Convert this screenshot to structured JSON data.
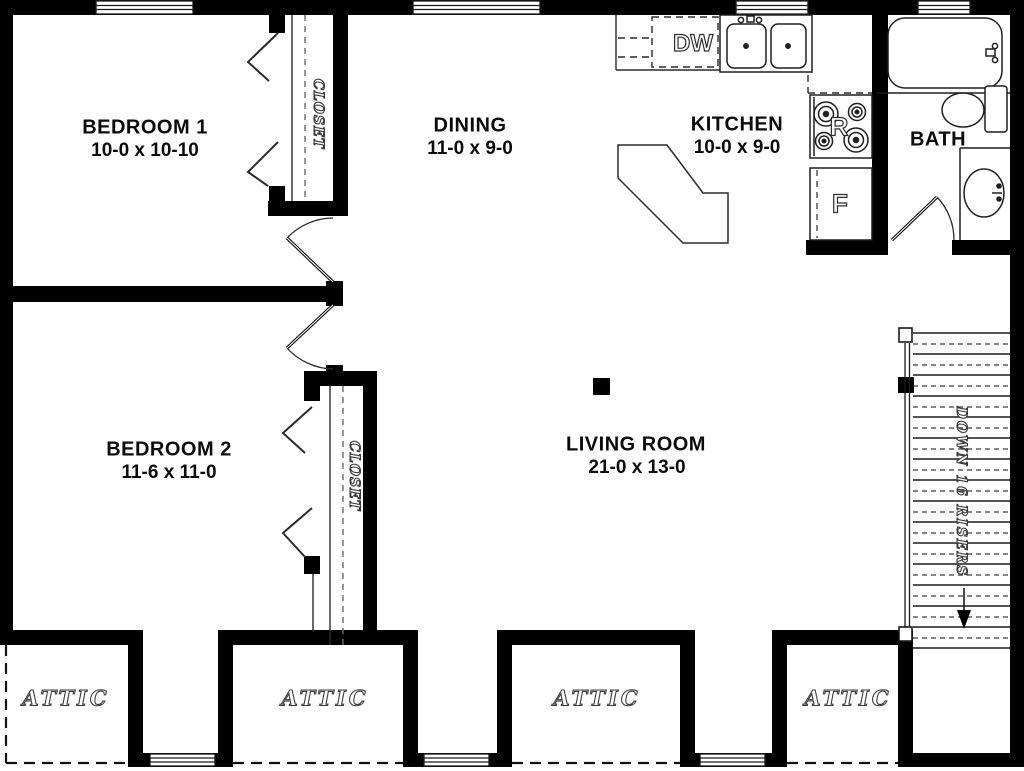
{
  "plan": {
    "rooms": [
      {
        "id": "bedroom-1",
        "name": "BEDROOM 1",
        "dims": "10-0 x 10-10"
      },
      {
        "id": "dining",
        "name": "DINING",
        "dims": "11-0 x 9-0"
      },
      {
        "id": "kitchen",
        "name": "KITCHEN",
        "dims": "10-0 x 9-0"
      },
      {
        "id": "bath",
        "name": "BATH",
        "dims": ""
      },
      {
        "id": "bedroom-2",
        "name": "BEDROOM 2",
        "dims": "11-6 x 11-0"
      },
      {
        "id": "living-room",
        "name": "LIVING ROOM",
        "dims": "21-0 x 13-0"
      }
    ],
    "closet_label": "CLOSET",
    "attic_label": "ATTIC",
    "attic_count": 4,
    "stairs": {
      "label": "DOWN 16 RISERS",
      "risers": 16
    },
    "appliances": {
      "dishwasher_label": "DW",
      "range_label": "R",
      "refrigerator_label": "F"
    },
    "colors": {
      "walls": "#000000",
      "background": "#ffffff",
      "thin_lines": "#2b2b2b"
    }
  }
}
